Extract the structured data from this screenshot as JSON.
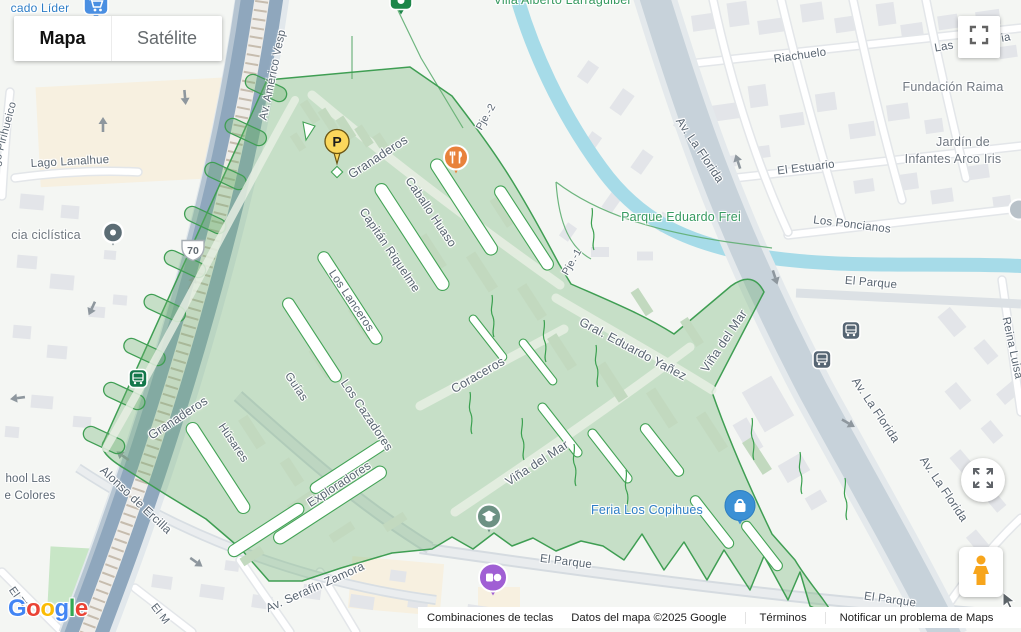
{
  "map_controls": {
    "map_label": "Mapa",
    "satellite_label": "Satélite"
  },
  "attribution": {
    "keyboard_shortcuts": "Combinaciones de teclas",
    "map_data": "Datos del mapa ©2025 Google",
    "terms": "Términos",
    "report_problem": "Notificar un problema de Maps"
  },
  "logo": {
    "text": "Google",
    "letters": [
      {
        "ch": "G",
        "c": "#4285F4"
      },
      {
        "ch": "o",
        "c": "#EA4335"
      },
      {
        "ch": "o",
        "c": "#FBBC05"
      },
      {
        "ch": "g",
        "c": "#4285F4"
      },
      {
        "ch": "l",
        "c": "#34A853"
      },
      {
        "ch": "e",
        "c": "#EA4335"
      }
    ]
  },
  "colors": {
    "region_fill": "rgba(105,175,110,0.33)",
    "region_stroke": "#3f9e53",
    "water": "#a6dbe8",
    "highway": "#93aabf",
    "road_major": "#c7d2da",
    "street_text": "#5a6672",
    "poi_text": "#6f7780",
    "park_text": "#379a60",
    "poi_blue_text": "#2e7ec7"
  },
  "labels": [
    {
      "t": "Av. Américo Vesp",
      "x": 273,
      "y": 75,
      "r": -78,
      "s": 11.5,
      "k": "street"
    },
    {
      "t": "Granaderos",
      "x": 378,
      "y": 157,
      "r": -33,
      "s": 12.5,
      "k": "street"
    },
    {
      "t": "Caballo Huaso",
      "x": 431,
      "y": 212,
      "r": 56,
      "s": 12,
      "k": "street"
    },
    {
      "t": "Capitán Riquelme",
      "x": 390,
      "y": 250,
      "r": 56,
      "s": 12,
      "k": "street"
    },
    {
      "t": "Los Lanceros",
      "x": 351,
      "y": 301,
      "r": 56,
      "s": 11.5,
      "k": "street"
    },
    {
      "t": "Pje.-2",
      "x": 486,
      "y": 117,
      "r": -60,
      "s": 10.5,
      "k": "street"
    },
    {
      "t": "Pje.-1",
      "x": 572,
      "y": 262,
      "r": -60,
      "s": 10.5,
      "k": "street"
    },
    {
      "t": "Granaderos",
      "x": 178,
      "y": 418,
      "r": -33,
      "s": 12.5,
      "k": "street"
    },
    {
      "t": "Húsares",
      "x": 233,
      "y": 443,
      "r": 56,
      "s": 11.5,
      "k": "street"
    },
    {
      "t": "Guías",
      "x": 296,
      "y": 387,
      "r": 56,
      "s": 11.5,
      "k": "street"
    },
    {
      "t": "Los Cazadores",
      "x": 367,
      "y": 415,
      "r": 56,
      "s": 12,
      "k": "street"
    },
    {
      "t": "Exploradores",
      "x": 339,
      "y": 484,
      "r": -33,
      "s": 12,
      "k": "street"
    },
    {
      "t": "Coraceros",
      "x": 478,
      "y": 375,
      "r": -30,
      "s": 12.5,
      "k": "street"
    },
    {
      "t": "Viña del Mar",
      "x": 537,
      "y": 463,
      "r": -33,
      "s": 12.5,
      "k": "street"
    },
    {
      "t": "Viña del Mar",
      "x": 724,
      "y": 341,
      "r": -56,
      "s": 12.5,
      "k": "street"
    },
    {
      "t": "Gral. Eduardo Yañez",
      "x": 633,
      "y": 349,
      "r": 28,
      "s": 12.5,
      "k": "street"
    },
    {
      "t": "Alonso de Ercilla",
      "x": 136,
      "y": 500,
      "r": 43,
      "s": 12,
      "k": "street"
    },
    {
      "t": "Av. Serafín Zamora",
      "x": 315,
      "y": 587,
      "r": -24,
      "s": 12,
      "k": "street"
    },
    {
      "t": "El Tilo",
      "x": 20,
      "y": 601,
      "r": 55,
      "s": 11,
      "k": "street"
    },
    {
      "t": "El M",
      "x": 160,
      "y": 614,
      "r": 52,
      "s": 11,
      "k": "street"
    },
    {
      "t": "El Parque",
      "x": 566,
      "y": 562,
      "r": 7,
      "s": 11.5,
      "k": "street"
    },
    {
      "t": "El Parque",
      "x": 890,
      "y": 600,
      "r": 8,
      "s": 11.5,
      "k": "street"
    },
    {
      "t": "El Parque",
      "x": 871,
      "y": 283,
      "r": 5,
      "s": 11.5,
      "k": "street"
    },
    {
      "t": "Los Poncianos",
      "x": 852,
      "y": 225,
      "r": 7,
      "s": 11.5,
      "k": "street"
    },
    {
      "t": "El Estuario",
      "x": 806,
      "y": 168,
      "r": -7,
      "s": 11.5,
      "k": "street"
    },
    {
      "t": "Riachuelo",
      "x": 800,
      "y": 56,
      "r": -8,
      "s": 11.5,
      "k": "street"
    },
    {
      "t": "Las",
      "x": 944,
      "y": 47,
      "r": -10,
      "s": 11.5,
      "k": "street"
    },
    {
      "t": "ia",
      "x": 1006,
      "y": 38,
      "r": -10,
      "s": 11.5,
      "k": "street"
    },
    {
      "t": "Reina Luisa",
      "x": 1012,
      "y": 348,
      "r": 78,
      "s": 11.5,
      "k": "street"
    },
    {
      "t": "Av. La Florida",
      "x": 700,
      "y": 150,
      "r": 56,
      "s": 12,
      "k": "street"
    },
    {
      "t": "Av. La Florida",
      "x": 876,
      "y": 410,
      "r": 56,
      "s": 12,
      "k": "street"
    },
    {
      "t": "Av. La Florida",
      "x": 944,
      "y": 489,
      "r": 56,
      "s": 12,
      "k": "street"
    },
    {
      "t": "Lago Pirihueico",
      "x": 3,
      "y": 140,
      "r": -75,
      "s": 11,
      "k": "street"
    },
    {
      "t": "Lago Lanalhue",
      "x": 70,
      "y": 162,
      "r": -3,
      "s": 11.5,
      "k": "street"
    },
    {
      "t": "hool Las",
      "x": 28,
      "y": 479,
      "r": 0,
      "s": 11.5,
      "k": "street"
    },
    {
      "t": "e Colores",
      "x": 30,
      "y": 496,
      "r": 0,
      "s": 11.5,
      "k": "street"
    },
    {
      "t": "Fundación Raima",
      "x": 953,
      "y": 87,
      "r": 0,
      "s": 12.5,
      "k": "poi"
    },
    {
      "t": "Jardín de",
      "x": 963,
      "y": 142,
      "r": 0,
      "s": 12.5,
      "k": "poi"
    },
    {
      "t": "Infantes Arco Iris",
      "x": 953,
      "y": 159,
      "r": 0,
      "s": 12.5,
      "k": "poi"
    },
    {
      "t": "cia ciclística",
      "x": 46,
      "y": 235,
      "r": 0,
      "s": 12.5,
      "k": "poi"
    },
    {
      "t": "Parque Eduardo Frei",
      "x": 681,
      "y": 217,
      "r": 0,
      "s": 12.5,
      "k": "park"
    },
    {
      "t": "Villa Alberto Larraguibel",
      "x": 562,
      "y": 0,
      "r": 0,
      "s": 12.5,
      "k": "park"
    },
    {
      "t": "cado Líder",
      "x": 40,
      "y": 8,
      "r": 0,
      "s": 12,
      "k": "blue"
    },
    {
      "t": "Feria Los Copihues",
      "x": 647,
      "y": 510,
      "r": 0,
      "s": 12.5,
      "k": "blue"
    }
  ],
  "markers": [
    {
      "type": "parking",
      "name": "parking-pin",
      "x": 337,
      "y": 150,
      "letter": "P"
    },
    {
      "type": "restaurant",
      "name": "restaurant-pin",
      "x": 456,
      "y": 160
    },
    {
      "type": "grocery",
      "name": "grocery-cart-pin",
      "x": 96,
      "y": 8
    },
    {
      "type": "green-shield",
      "name": "villa-poi-pin",
      "x": 401,
      "y": 6
    },
    {
      "type": "poi-dot",
      "name": "cycling-poi-dot",
      "x": 113,
      "y": 235
    },
    {
      "type": "bus-green",
      "name": "bus-stop-green",
      "x": 138,
      "y": 381
    },
    {
      "type": "bus",
      "name": "bus-stop",
      "x": 851,
      "y": 333
    },
    {
      "type": "bus",
      "name": "bus-stop",
      "x": 822,
      "y": 362
    },
    {
      "type": "school",
      "name": "school-pin",
      "x": 489,
      "y": 519
    },
    {
      "type": "shop-purple",
      "name": "shopping-purple-pin",
      "x": 493,
      "y": 580
    },
    {
      "type": "shop-blue",
      "name": "feria-los-copihues-pin",
      "x": 740,
      "y": 508
    },
    {
      "type": "route-shield",
      "name": "route-70-shield",
      "x": 193,
      "y": 253,
      "text": "70"
    },
    {
      "type": "poi-partial",
      "name": "edge-poi-circle",
      "x": 1019,
      "y": 212
    },
    {
      "type": "cursor",
      "name": "mouse-cursor",
      "x": 1009,
      "y": 604
    }
  ]
}
